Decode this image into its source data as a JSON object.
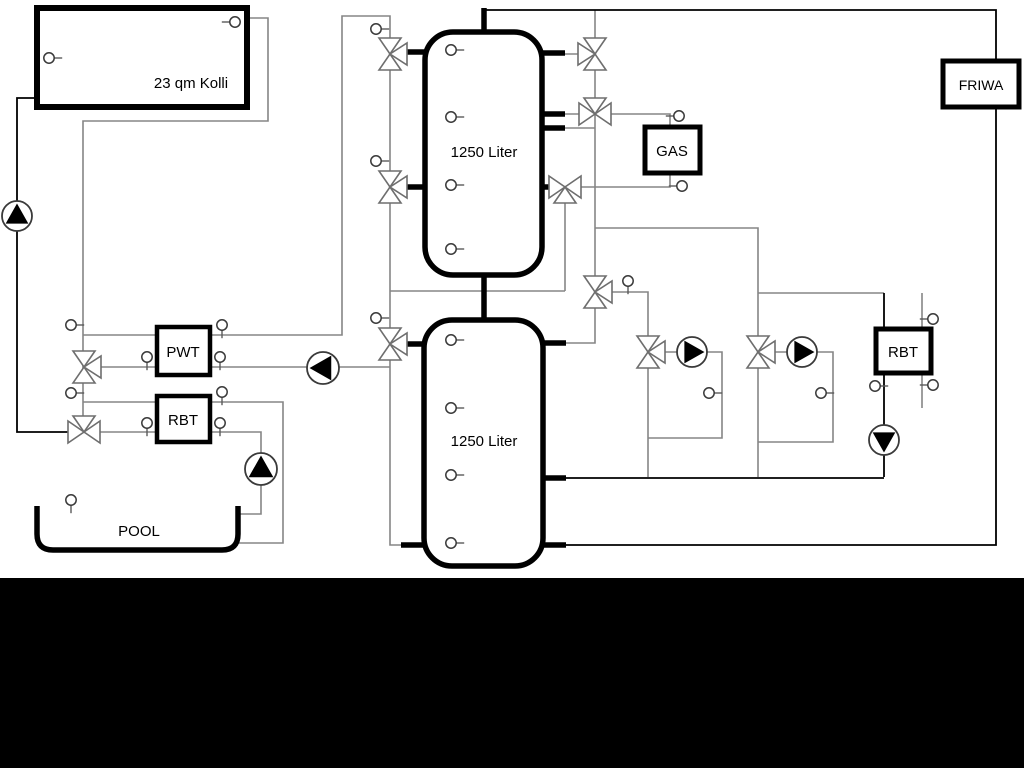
{
  "diagram": {
    "collector_label": "23 qm Kolli",
    "tank1_label": "1250 Liter",
    "tank2_label": "1250 Liter",
    "gas_label": "GAS",
    "friwa_label": "FRIWA",
    "pwt_label": "PWT",
    "rbt_left_label": "RBT",
    "rbt_right_label": "RBT",
    "pool_label": "POOL"
  },
  "colors": {
    "pipe_gray": "#858585",
    "pipe_black": "#000000",
    "component_outline": "#6e6e6e",
    "box_border": "#000000",
    "background": "#ffffff",
    "bottom_band": "#000000"
  },
  "icons": {
    "three_way_valve": "two or three hollow triangles meeting at a point",
    "pump": "circle with solid black triangle showing flow direction",
    "temperature_sensor": "small hollow circle with short stem"
  }
}
